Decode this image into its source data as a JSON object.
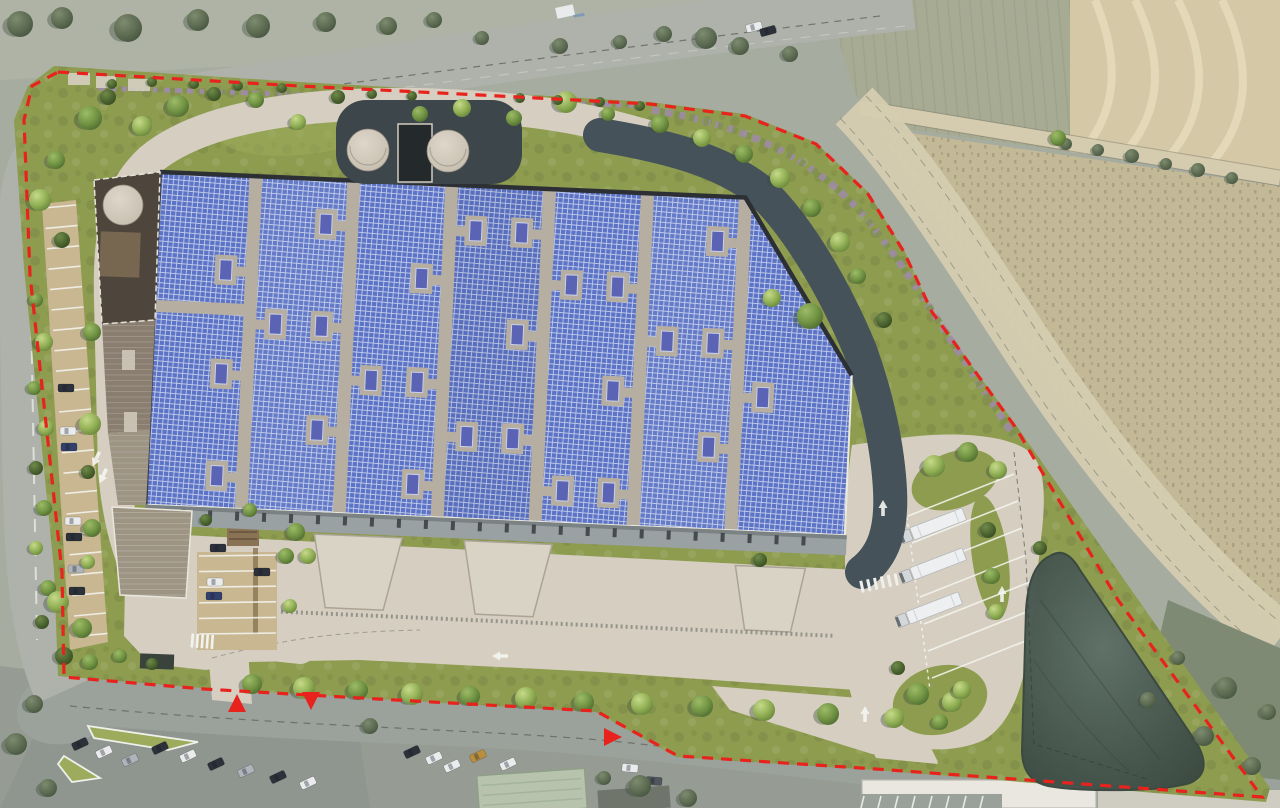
{
  "palette": {
    "aerial-base": "#a7aca0",
    "land-top": "#aeb3a5",
    "road-gray": "#aeb2ab",
    "road-bottom": "#9ba19b",
    "lot-gray": "#8f958f",
    "concrete": "#d6cfc1",
    "asphalt": "#45525a",
    "pad-dark": "#3d474b",
    "grass": "#8e9c50",
    "grass2": "#9dab5c",
    "tree-shadow": "#3d4b40",
    "stall-tan": "#c9b792",
    "walkway": "#b6aea1",
    "solar": "#5d74c6",
    "solar-line": "#c3cdeb",
    "skylight": "#5a63b4",
    "parapet": "#2c3034",
    "canopy": "#9aa1a3",
    "office-dark": "#4e463c",
    "office-mid": "#8a7e70",
    "office-low": "#9d9484",
    "tank": "#cdc5b7",
    "field-a": "#a7ab93",
    "field-b": "#d4c8a6",
    "field-c": "#c3b997",
    "field-line": "#8f8a72",
    "track": "#d5ccb0",
    "flower": "#a08ab0",
    "red": "#e8231e",
    "bldg-green": "#b7c3ad",
    "bldg-white": "#e9e7e0",
    "pond-edge": "#39473f"
  },
  "boundary": {
    "points": "58,72 300,86 480,95 650,104 745,116 816,144 868,194 904,252 932,312 1016,428 1118,600 1262,797 876,769 678,756 596,711 378,699 204,689 64,677 62,572 30,275 24,120 32,86",
    "dash": "11 8",
    "width": 3.2
  },
  "markers": [
    {
      "x": 237,
      "y": 704,
      "rot": 0
    },
    {
      "x": 311,
      "y": 700,
      "rot": 180
    },
    {
      "x": 612,
      "y": 737,
      "rot": 90
    }
  ],
  "skylights": {
    "strips": [
      256,
      354,
      452,
      550,
      648,
      746
    ],
    "rows": [
      204,
      254,
      306,
      358,
      410,
      460
    ]
  },
  "dock_ticks": {
    "x0": 196,
    "x1": 844,
    "step": 27,
    "y": 508
  },
  "trucks": {
    "angle": -21,
    "positions": [
      [
        912,
        534
      ],
      [
        912,
        574
      ],
      [
        908,
        618
      ]
    ]
  },
  "stall_lines": [
    {
      "x1": 44,
      "y1": 208,
      "x2": 76,
      "y2": 205,
      "count": 22,
      "dx": 1.5,
      "dy": 20.4
    },
    {
      "x1": 199,
      "y1": 556,
      "x2": 276,
      "y2": 555,
      "count": 6,
      "dx": 0,
      "dy": 15.6
    },
    {
      "x1": 908,
      "y1": 516,
      "x2": 1014,
      "y2": 474,
      "count": 7,
      "dx": 4,
      "dy": 27
    },
    {
      "x1": 864,
      "y1": 796,
      "x2": 861,
      "y2": 808,
      "count": 8,
      "dx": 17,
      "dy": 0
    }
  ],
  "arrows": [
    [
      1002,
      594,
      0
    ],
    [
      865,
      714,
      0
    ],
    [
      96,
      459,
      205
    ],
    [
      103,
      476,
      205
    ],
    [
      500,
      656,
      270
    ],
    [
      883,
      508,
      0
    ]
  ],
  "car_colors": [
    "#2c313a",
    "#e9ebec",
    "#aeb4ba",
    "#33406b",
    "#b98f3e",
    "#50565c"
  ],
  "cars": [
    [
      66,
      388,
      0,
      0
    ],
    [
      68,
      431,
      0,
      1
    ],
    [
      69,
      447,
      0,
      3
    ],
    [
      73,
      521,
      0,
      1
    ],
    [
      74,
      537,
      0,
      0
    ],
    [
      76,
      569,
      0,
      2
    ],
    [
      77,
      591,
      0,
      0
    ],
    [
      218,
      548,
      0,
      0
    ],
    [
      215,
      582,
      0,
      1
    ],
    [
      214,
      596,
      0,
      3
    ],
    [
      262,
      572,
      0,
      0
    ],
    [
      80,
      744,
      -25,
      0
    ],
    [
      104,
      752,
      -25,
      1
    ],
    [
      130,
      760,
      -25,
      2
    ],
    [
      160,
      748,
      -25,
      0
    ],
    [
      188,
      756,
      -25,
      1
    ],
    [
      216,
      764,
      -25,
      0
    ],
    [
      246,
      771,
      -25,
      2
    ],
    [
      278,
      777,
      -25,
      0
    ],
    [
      308,
      783,
      -25,
      1
    ],
    [
      412,
      752,
      -25,
      0
    ],
    [
      434,
      758,
      -25,
      1
    ],
    [
      452,
      766,
      -25,
      1
    ],
    [
      478,
      756,
      -25,
      4
    ],
    [
      508,
      764,
      -25,
      1
    ],
    [
      630,
      768,
      5,
      1
    ],
    [
      654,
      781,
      5,
      5
    ],
    [
      754,
      27,
      -15,
      1
    ],
    [
      768,
      31,
      -15,
      0
    ]
  ],
  "trees": [
    [
      90,
      118,
      12,
      1
    ],
    [
      108,
      97,
      8,
      2
    ],
    [
      142,
      126,
      10,
      0
    ],
    [
      178,
      106,
      11,
      1
    ],
    [
      214,
      94,
      7,
      2
    ],
    [
      256,
      100,
      8,
      1
    ],
    [
      298,
      122,
      8,
      0
    ],
    [
      338,
      97,
      7,
      2
    ],
    [
      420,
      114,
      8,
      1
    ],
    [
      462,
      108,
      9,
      0
    ],
    [
      514,
      118,
      8,
      1
    ],
    [
      566,
      102,
      11,
      0
    ],
    [
      608,
      114,
      7,
      1
    ],
    [
      660,
      124,
      9,
      1
    ],
    [
      702,
      138,
      9,
      0
    ],
    [
      744,
      154,
      9,
      1
    ],
    [
      780,
      178,
      10,
      0
    ],
    [
      812,
      208,
      9,
      1
    ],
    [
      840,
      242,
      10,
      0
    ],
    [
      858,
      276,
      8,
      1
    ],
    [
      810,
      316,
      13,
      1
    ],
    [
      772,
      298,
      9,
      0
    ],
    [
      884,
      320,
      8,
      2
    ],
    [
      112,
      84,
      5,
      2
    ],
    [
      152,
      82,
      5,
      2
    ],
    [
      194,
      84,
      5,
      2
    ],
    [
      238,
      86,
      5,
      2
    ],
    [
      282,
      88,
      5,
      2
    ],
    [
      372,
      94,
      5,
      2
    ],
    [
      412,
      96,
      5,
      2
    ],
    [
      520,
      98,
      5,
      2
    ],
    [
      558,
      100,
      5,
      2
    ],
    [
      600,
      102,
      5,
      2
    ],
    [
      640,
      106,
      5,
      2
    ],
    [
      56,
      160,
      9,
      1
    ],
    [
      40,
      200,
      11,
      0
    ],
    [
      62,
      240,
      8,
      2
    ],
    [
      36,
      300,
      7,
      1
    ],
    [
      44,
      342,
      9,
      0
    ],
    [
      34,
      388,
      7,
      1
    ],
    [
      46,
      428,
      8,
      0
    ],
    [
      36,
      468,
      7,
      2
    ],
    [
      44,
      508,
      8,
      1
    ],
    [
      36,
      548,
      7,
      0
    ],
    [
      48,
      588,
      8,
      1
    ],
    [
      42,
      622,
      7,
      2
    ],
    [
      58,
      602,
      11,
      0
    ],
    [
      82,
      628,
      10,
      1
    ],
    [
      64,
      656,
      9,
      2
    ],
    [
      90,
      662,
      8,
      1
    ],
    [
      120,
      656,
      7,
      1
    ],
    [
      152,
      664,
      6,
      2
    ],
    [
      92,
      332,
      9,
      1
    ],
    [
      90,
      424,
      11,
      0
    ],
    [
      88,
      472,
      7,
      2
    ],
    [
      92,
      528,
      9,
      1
    ],
    [
      88,
      562,
      7,
      0
    ],
    [
      286,
      556,
      8,
      1
    ],
    [
      290,
      606,
      7,
      0
    ],
    [
      206,
      520,
      6,
      2
    ],
    [
      250,
      510,
      7,
      1
    ],
    [
      296,
      532,
      9,
      1
    ],
    [
      308,
      556,
      8,
      0
    ],
    [
      760,
      560,
      7,
      2
    ],
    [
      252,
      684,
      10,
      1
    ],
    [
      304,
      688,
      11,
      0
    ],
    [
      358,
      690,
      10,
      1
    ],
    [
      412,
      694,
      11,
      0
    ],
    [
      470,
      696,
      10,
      1
    ],
    [
      526,
      698,
      11,
      0
    ],
    [
      584,
      702,
      10,
      1
    ],
    [
      642,
      704,
      11,
      0
    ],
    [
      702,
      706,
      11,
      1
    ],
    [
      764,
      710,
      11,
      0
    ],
    [
      828,
      714,
      11,
      1
    ],
    [
      894,
      718,
      10,
      0
    ],
    [
      940,
      722,
      8,
      1
    ],
    [
      934,
      466,
      11,
      0
    ],
    [
      968,
      452,
      10,
      1
    ],
    [
      998,
      470,
      9,
      0
    ],
    [
      988,
      530,
      8,
      2
    ],
    [
      992,
      576,
      8,
      1
    ],
    [
      996,
      612,
      8,
      0
    ],
    [
      918,
      694,
      11,
      1
    ],
    [
      952,
      702,
      10,
      0
    ],
    [
      898,
      668,
      7,
      2
    ],
    [
      1040,
      548,
      7,
      2
    ],
    [
      962,
      690,
      9,
      0
    ],
    [
      20,
      24,
      13,
      3
    ],
    [
      62,
      18,
      11,
      3
    ],
    [
      128,
      28,
      14,
      3
    ],
    [
      198,
      20,
      11,
      3
    ],
    [
      258,
      26,
      12,
      3
    ],
    [
      326,
      22,
      10,
      3
    ],
    [
      388,
      26,
      9,
      3
    ],
    [
      434,
      20,
      8,
      3
    ],
    [
      482,
      38,
      7,
      3
    ],
    [
      560,
      46,
      8,
      3
    ],
    [
      620,
      42,
      7,
      3
    ],
    [
      664,
      34,
      8,
      3
    ],
    [
      706,
      38,
      11,
      3
    ],
    [
      740,
      46,
      9,
      3
    ],
    [
      790,
      54,
      8,
      3
    ],
    [
      1066,
      144,
      6,
      3
    ],
    [
      1098,
      150,
      6,
      3
    ],
    [
      1132,
      156,
      7,
      3
    ],
    [
      1166,
      164,
      6,
      3
    ],
    [
      1198,
      170,
      7,
      3
    ],
    [
      1232,
      178,
      6,
      3
    ],
    [
      1058,
      138,
      8,
      1
    ],
    [
      34,
      704,
      9,
      3
    ],
    [
      16,
      744,
      11,
      3
    ],
    [
      48,
      788,
      9,
      3
    ],
    [
      370,
      726,
      8,
      3
    ],
    [
      640,
      786,
      11,
      3
    ],
    [
      688,
      798,
      9,
      3
    ],
    [
      604,
      778,
      7,
      3
    ],
    [
      1226,
      688,
      11,
      3
    ],
    [
      1204,
      736,
      10,
      3
    ],
    [
      1252,
      766,
      9,
      3
    ],
    [
      1268,
      712,
      8,
      3
    ],
    [
      1178,
      658,
      7,
      3
    ],
    [
      1148,
      700,
      8,
      3
    ]
  ]
}
